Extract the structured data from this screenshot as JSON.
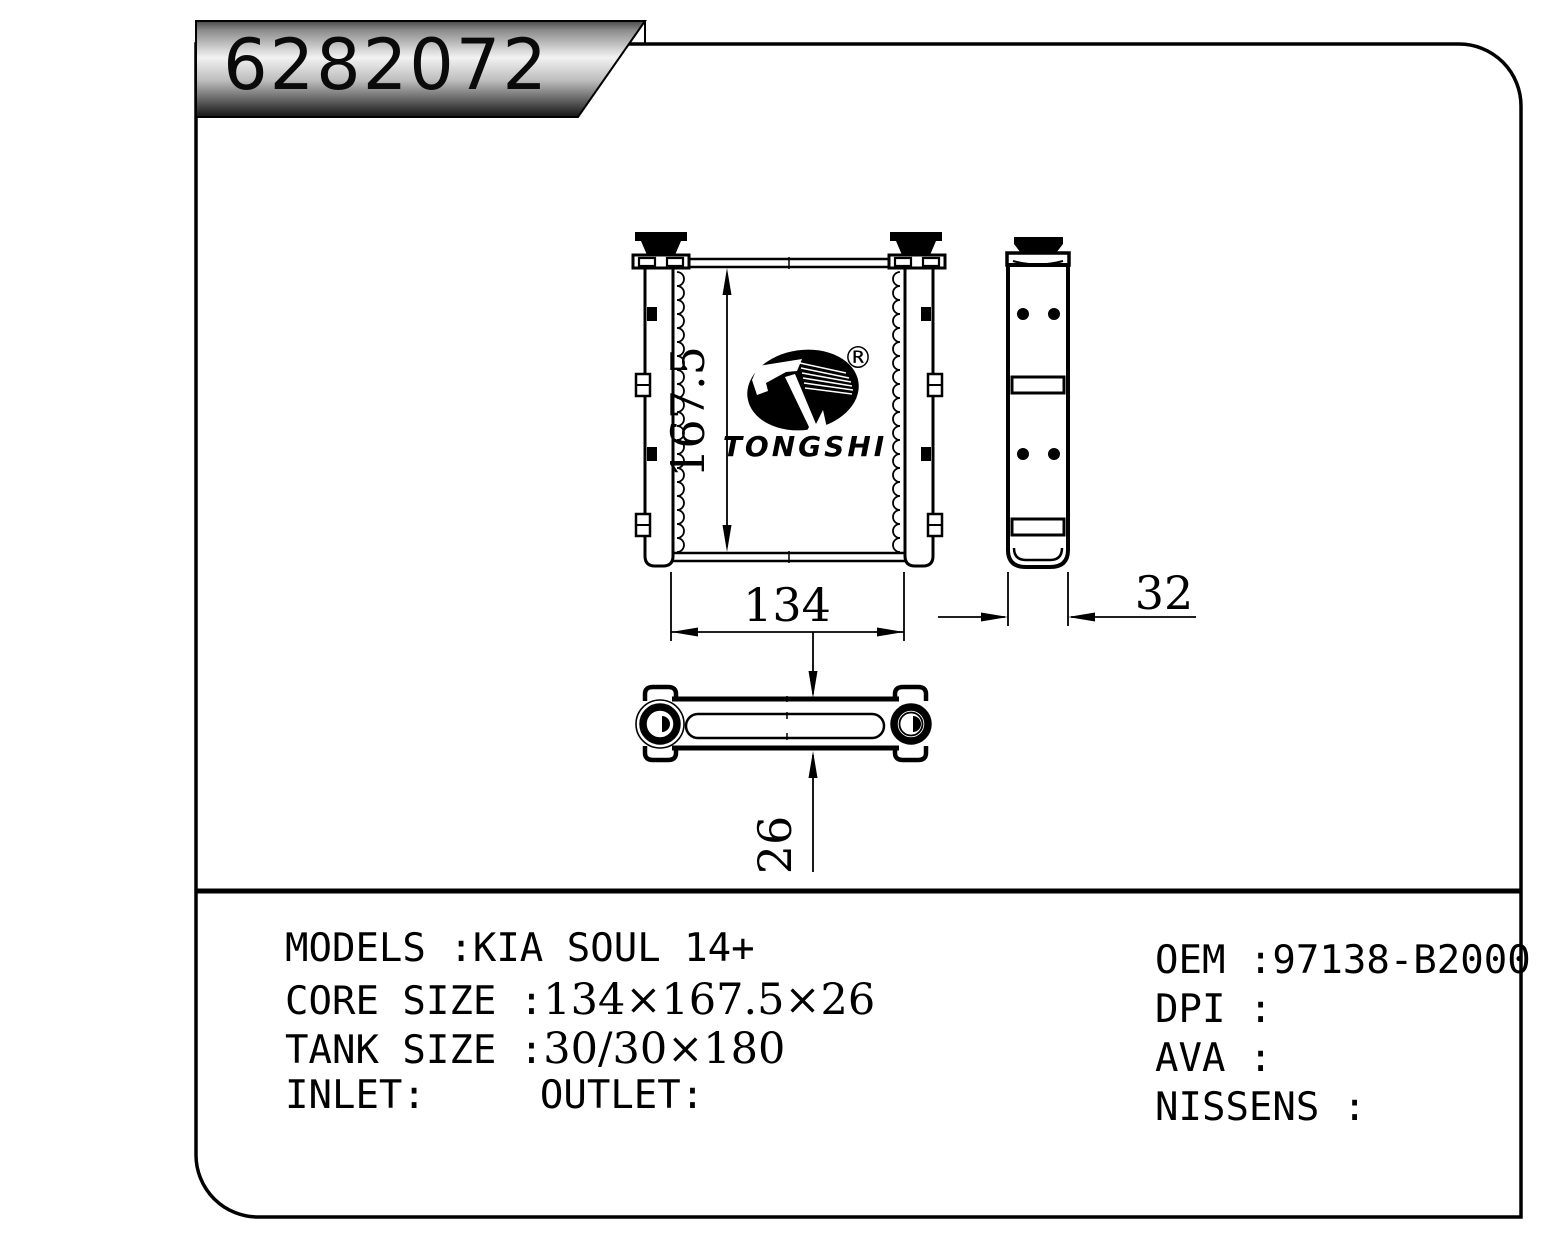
{
  "banner": {
    "part_number": "6282072"
  },
  "logo": {
    "brand": "TONGSHI",
    "registered_mark": "®"
  },
  "dimensions": {
    "height": "167.5",
    "width": "134",
    "depth": "32",
    "thickness": "26"
  },
  "specs": {
    "left": [
      {
        "label": "MODELS :",
        "value": "KIA SOUL 14+"
      },
      {
        "label": "CORE SIZE :",
        "value": "134×167.5×26"
      },
      {
        "label": "TANK SIZE :",
        "value": "30/30×180"
      },
      {
        "label": "INLET:",
        "label2": "OUTLET:"
      }
    ],
    "right": [
      {
        "label": "OEM :",
        "value": "97138-B2000"
      },
      {
        "label": "DPI :",
        "value": ""
      },
      {
        "label": "AVA :",
        "value": ""
      },
      {
        "label": "NISSENS :",
        "value": ""
      }
    ]
  },
  "colors": {
    "ink": "#000000",
    "paper": "#ffffff"
  }
}
